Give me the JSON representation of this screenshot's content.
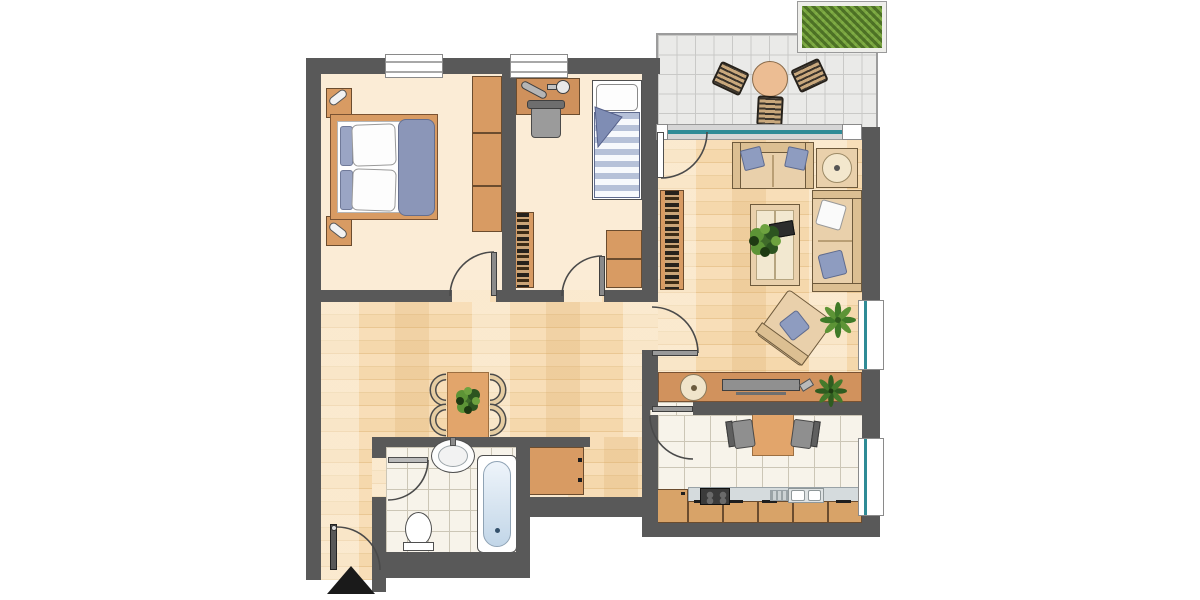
{
  "plan_type": "apartment-floor-plan",
  "colors": {
    "wall": "#595959",
    "cream": "#fbecd6",
    "glass": "#2f8b96",
    "wood": "#d89b63",
    "woodDark": "#6b4c2e",
    "cabinet": "#d8a368",
    "sofa": "#e9d0ab",
    "sofaTrim": "#6e5a3c",
    "sofaBack": "#dcbf92",
    "pillow": "#8e9cc0",
    "blanket": "#8b96b8",
    "table": "#e2a56b",
    "tableStroke": "#9c6f41",
    "arc": "#4a4a4a",
    "plantDark": "#2f5c20",
    "plantLight": "#5d9436",
    "hedgeGreen": "#79a340",
    "balconyTile": "#eaeae8",
    "kitchenTile": "#f7f3ea",
    "floorWood": "#f6d9b0",
    "entranceMarker": "#1a1a1a"
  },
  "rooms": [
    {
      "id": "bedroom",
      "name": "bedroom",
      "floor": "cream",
      "furniture": [
        "double-bed",
        "nightstand-top",
        "nightstand-bottom",
        "bedside-lamps",
        "wardrobe"
      ]
    },
    {
      "id": "kids-room",
      "name": "kids-room",
      "floor": "cream",
      "furniture": [
        "desk",
        "desk-lamp",
        "desk-chair",
        "single-bed",
        "bookshelf",
        "chest-of-drawers"
      ]
    },
    {
      "id": "living-room",
      "name": "living-room",
      "floor": "wood",
      "furniture": [
        "loveseat",
        "side-table",
        "three-seat-sofa",
        "coffee-table",
        "armchair",
        "bookshelf",
        "sideboard",
        "tv",
        "floor-plant",
        "sideboard-plant"
      ]
    },
    {
      "id": "kitchen",
      "name": "kitchen",
      "floor": "tile",
      "furniture": [
        "kitchen-table",
        "two-chairs",
        "counter",
        "stove",
        "sink",
        "tall-cabinet"
      ]
    },
    {
      "id": "bathroom",
      "name": "bathroom",
      "floor": "tile",
      "furniture": [
        "washbasin",
        "toilet",
        "bathtub"
      ]
    },
    {
      "id": "hallway",
      "name": "hallway",
      "floor": "wood",
      "furniture": [
        "dining-table",
        "four-chairs",
        "table-plant",
        "hall-cabinet"
      ]
    },
    {
      "id": "balcony",
      "name": "balcony",
      "floor": "balcony-tile",
      "furniture": [
        "round-table",
        "three-woven-chairs",
        "planter-hedge"
      ]
    }
  ],
  "doors": [
    "entrance-door",
    "bedroom-door",
    "kids-room-door",
    "living-room-door",
    "kitchen-door",
    "bathroom-door",
    "balcony-door"
  ],
  "windows": [
    "bedroom-window",
    "kids-room-window",
    "living-room-window",
    "kitchen-window",
    "balcony-glazing"
  ],
  "entrance_marker": "black-triangle-arrow"
}
